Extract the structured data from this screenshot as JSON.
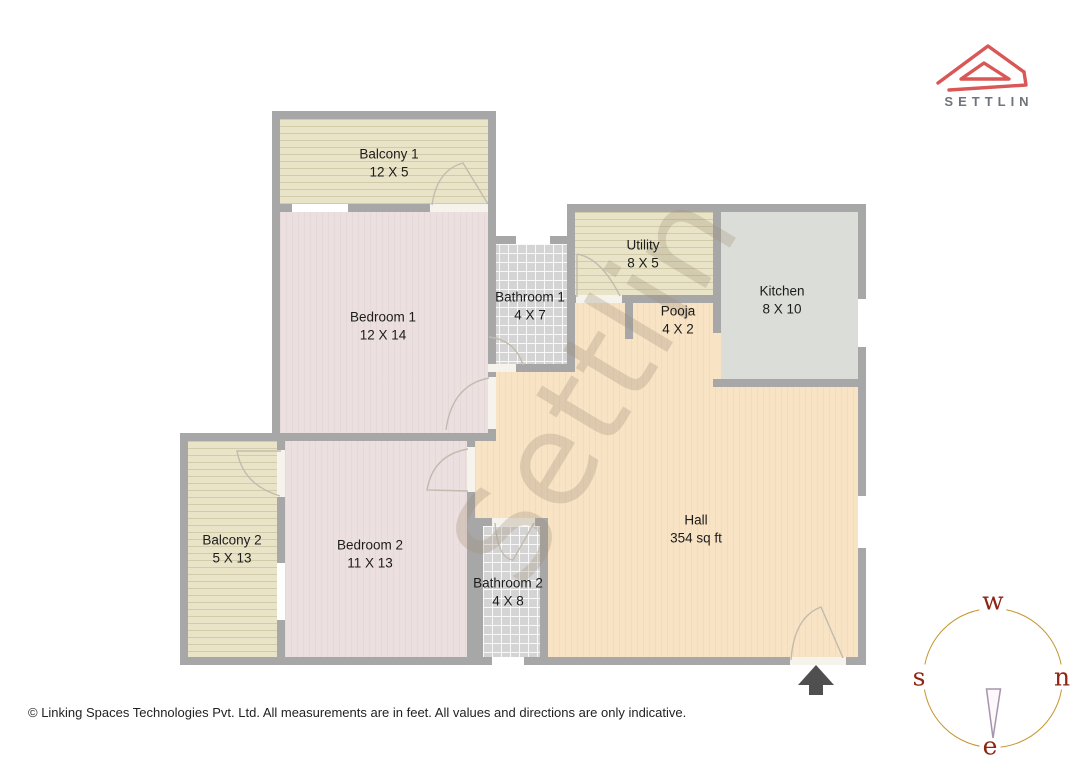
{
  "brand": {
    "name": "SETTLIN"
  },
  "watermark": "Settlin",
  "footer": "© Linking Spaces Technologies Pvt. Ltd. All measurements are in feet. All values and directions are only indicative.",
  "rooms": [
    {
      "name": "Balcony 1",
      "dims": "12 X 5"
    },
    {
      "name": "Bedroom 1",
      "dims": "12 X 14"
    },
    {
      "name": "Bathroom 1",
      "dims": "4 X 7"
    },
    {
      "name": "Utility",
      "dims": "8 X 5"
    },
    {
      "name": "Pooja",
      "dims": "4 X 2"
    },
    {
      "name": "Kitchen",
      "dims": "8 X 10"
    },
    {
      "name": "Hall",
      "dims": "354 sq ft"
    },
    {
      "name": "Bathroom 2",
      "dims": "4 X 8"
    },
    {
      "name": "Bedroom 2",
      "dims": "11 X 13"
    },
    {
      "name": "Balcony 2",
      "dims": "5 X 13"
    }
  ],
  "compass": {
    "top": "w",
    "left": "s",
    "right": "n",
    "bottom": "e"
  },
  "colors": {
    "wall": "#a7a7a7",
    "hall_floor": "#f8e3c5",
    "bedroom_floor": "#ecdfdf",
    "balcony_floor": "#e9e4c8",
    "bathroom_floor": "#d4d4d4",
    "kitchen_floor": "#dbddd8",
    "logo_red": "#d95757",
    "compass_ring": "#c5952e",
    "compass_letters": "#8e2413"
  }
}
